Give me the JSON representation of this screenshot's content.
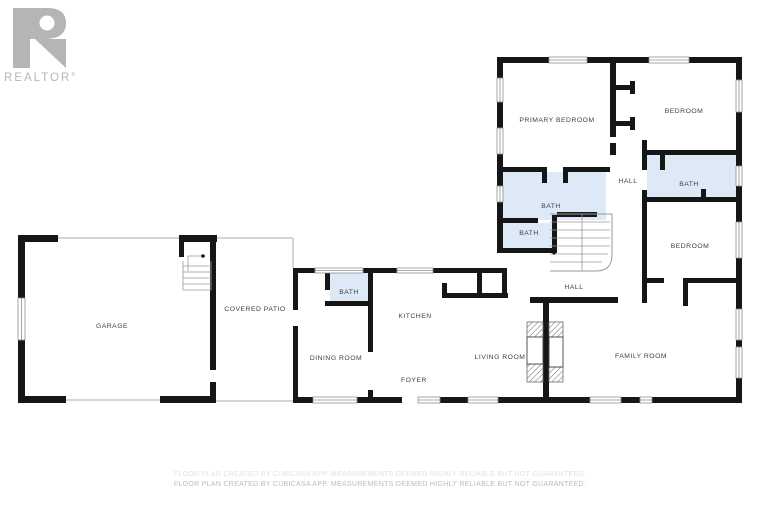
{
  "logo": {
    "letter": "R",
    "wordmark": "REALTOR",
    "registered": "®",
    "color": "#b5b5b5"
  },
  "disclaimer": {
    "text": "FLOOR PLAN CREATED BY CUBICASA APP. MEASUREMENTS DEEMED HIGHLY RELIABLE BUT NOT GUARANTEED."
  },
  "floorplan": {
    "colors": {
      "wall": "#161616",
      "bath_fill": "#dde9f6",
      "window_line": "#8f8f8f",
      "thin_line": "#aeaeae",
      "stair_line": "#9a9a9a",
      "label": "#3f3f3f",
      "hatch": "#6a6a6a"
    },
    "rooms": [
      {
        "label": "PRIMARY BEDROOM",
        "x": 557,
        "y": 120
      },
      {
        "label": "BEDROOM",
        "x": 684,
        "y": 111
      },
      {
        "label": "HALL",
        "x": 628,
        "y": 181
      },
      {
        "label": "BATH",
        "x": 689,
        "y": 184
      },
      {
        "label": "BEDROOM",
        "x": 690,
        "y": 246
      },
      {
        "label": "BATH",
        "x": 551,
        "y": 206
      },
      {
        "label": "BATH",
        "x": 529,
        "y": 233
      },
      {
        "label": "HALL",
        "x": 574,
        "y": 287
      },
      {
        "label": "GARAGE",
        "x": 112,
        "y": 326
      },
      {
        "label": "COVERED PATIO",
        "x": 255,
        "y": 309
      },
      {
        "label": "BATH",
        "x": 349,
        "y": 292
      },
      {
        "label": "KITCHEN",
        "x": 415,
        "y": 316
      },
      {
        "label": "DINING ROOM",
        "x": 336,
        "y": 358
      },
      {
        "label": "FOYER",
        "x": 414,
        "y": 380
      },
      {
        "label": "LIVING ROOM",
        "x": 500,
        "y": 357
      },
      {
        "label": "FAMILY ROOM",
        "x": 641,
        "y": 356
      }
    ],
    "bath_areas": [
      [
        503,
        172,
        103,
        48
      ],
      [
        503,
        223,
        50,
        27
      ],
      [
        647,
        155,
        89,
        42
      ],
      [
        330,
        272,
        40,
        30
      ]
    ],
    "walls": [
      [
        497,
        57,
        245,
        6
      ],
      [
        497,
        57,
        6,
        196
      ],
      [
        736,
        57,
        6,
        346
      ],
      [
        610,
        57,
        6,
        80
      ],
      [
        610,
        143,
        6,
        12
      ],
      [
        616,
        85,
        18,
        5
      ],
      [
        630,
        81,
        5,
        13
      ],
      [
        616,
        121,
        18,
        5
      ],
      [
        630,
        117,
        5,
        13
      ],
      [
        642,
        150,
        96,
        5
      ],
      [
        660,
        150,
        5,
        20
      ],
      [
        642,
        140,
        5,
        30
      ],
      [
        642,
        190,
        5,
        113
      ],
      [
        642,
        197,
        96,
        5
      ],
      [
        701,
        189,
        5,
        8
      ],
      [
        642,
        278,
        22,
        5
      ],
      [
        683,
        278,
        55,
        5
      ],
      [
        683,
        278,
        5,
        28
      ],
      [
        497,
        167,
        50,
        5
      ],
      [
        563,
        167,
        47,
        5
      ],
      [
        542,
        167,
        5,
        16
      ],
      [
        563,
        167,
        5,
        16
      ],
      [
        497,
        248,
        60,
        5
      ],
      [
        552,
        215,
        5,
        38
      ],
      [
        503,
        218,
        35,
        5
      ],
      [
        557,
        212,
        40,
        5
      ],
      [
        530,
        297,
        88,
        6
      ],
      [
        543,
        297,
        6,
        106
      ],
      [
        293,
        268,
        214,
        5
      ],
      [
        293,
        268,
        5,
        42
      ],
      [
        293,
        326,
        5,
        77
      ],
      [
        293,
        397,
        20,
        6
      ],
      [
        357,
        397,
        45,
        6
      ],
      [
        440,
        397,
        28,
        6
      ],
      [
        498,
        397,
        92,
        6
      ],
      [
        621,
        397,
        19,
        6
      ],
      [
        652,
        397,
        90,
        6
      ],
      [
        368,
        268,
        5,
        84
      ],
      [
        368,
        390,
        5,
        7
      ],
      [
        325,
        268,
        5,
        22
      ],
      [
        325,
        301,
        48,
        5
      ],
      [
        442,
        293,
        66,
        5
      ],
      [
        442,
        283,
        5,
        12
      ],
      [
        477,
        268,
        5,
        27
      ],
      [
        502,
        268,
        5,
        30
      ],
      [
        18,
        235,
        40,
        7
      ],
      [
        179,
        235,
        38,
        7
      ],
      [
        18,
        235,
        7,
        168
      ],
      [
        18,
        396,
        48,
        7
      ],
      [
        160,
        396,
        56,
        7
      ],
      [
        210,
        237,
        6,
        133
      ],
      [
        210,
        382,
        6,
        21
      ],
      [
        179,
        235,
        5,
        22
      ]
    ],
    "windows": [
      [
        549,
        57,
        38,
        6
      ],
      [
        649,
        57,
        40,
        6
      ],
      [
        497,
        78,
        6,
        24
      ],
      [
        497,
        128,
        6,
        26
      ],
      [
        497,
        186,
        6,
        16
      ],
      [
        736,
        80,
        6,
        32
      ],
      [
        736,
        166,
        6,
        20
      ],
      [
        736,
        222,
        6,
        36
      ],
      [
        736,
        309,
        6,
        31
      ],
      [
        736,
        347,
        6,
        31
      ],
      [
        315,
        268,
        48,
        5
      ],
      [
        397,
        268,
        36,
        5
      ],
      [
        313,
        397,
        44,
        6
      ],
      [
        418,
        397,
        22,
        6
      ],
      [
        468,
        397,
        30,
        6
      ],
      [
        590,
        397,
        31,
        6
      ],
      [
        640,
        397,
        12,
        6
      ],
      [
        18,
        298,
        7,
        42
      ]
    ],
    "thin_lines": [
      [
        57,
        238,
        293,
        238
      ],
      [
        293,
        238,
        293,
        268
      ],
      [
        66,
        400,
        160,
        400
      ],
      [
        216,
        401,
        293,
        401
      ]
    ],
    "hall_stairs": {
      "outline": "M550,214 H612 V255 Q612,271 596,271 H550",
      "treads_h": [
        [
          550,
          222,
          610,
          222
        ],
        [
          550,
          230,
          610,
          230
        ],
        [
          550,
          238,
          610,
          238
        ],
        [
          550,
          246,
          610,
          246
        ],
        [
          550,
          254,
          608,
          254
        ],
        [
          550,
          262,
          602,
          262
        ]
      ],
      "center_line": [
        582,
        214,
        582,
        271
      ],
      "dot": [
        554,
        253
      ]
    },
    "garage_stairs": {
      "treads": [
        [
          183,
          266,
          211,
          266
        ],
        [
          183,
          272,
          211,
          272
        ],
        [
          183,
          278,
          211,
          278
        ],
        [
          183,
          284,
          211,
          284
        ],
        [
          183,
          290,
          211,
          290
        ]
      ],
      "side_lines": [
        [
          183,
          261,
          183,
          290
        ],
        [
          211,
          261,
          211,
          290
        ]
      ],
      "arrow": "M188,271 L188,256 L202,256",
      "dot": [
        203,
        256
      ]
    },
    "fireplace": {
      "hatched": [
        [
          527,
          322,
          16,
          15
        ],
        [
          527,
          364,
          16,
          18
        ],
        [
          549,
          322,
          14,
          15
        ],
        [
          549,
          367,
          14,
          15
        ]
      ],
      "open": [
        [
          527,
          337,
          16,
          27
        ],
        [
          549,
          337,
          14,
          30
        ]
      ]
    }
  }
}
